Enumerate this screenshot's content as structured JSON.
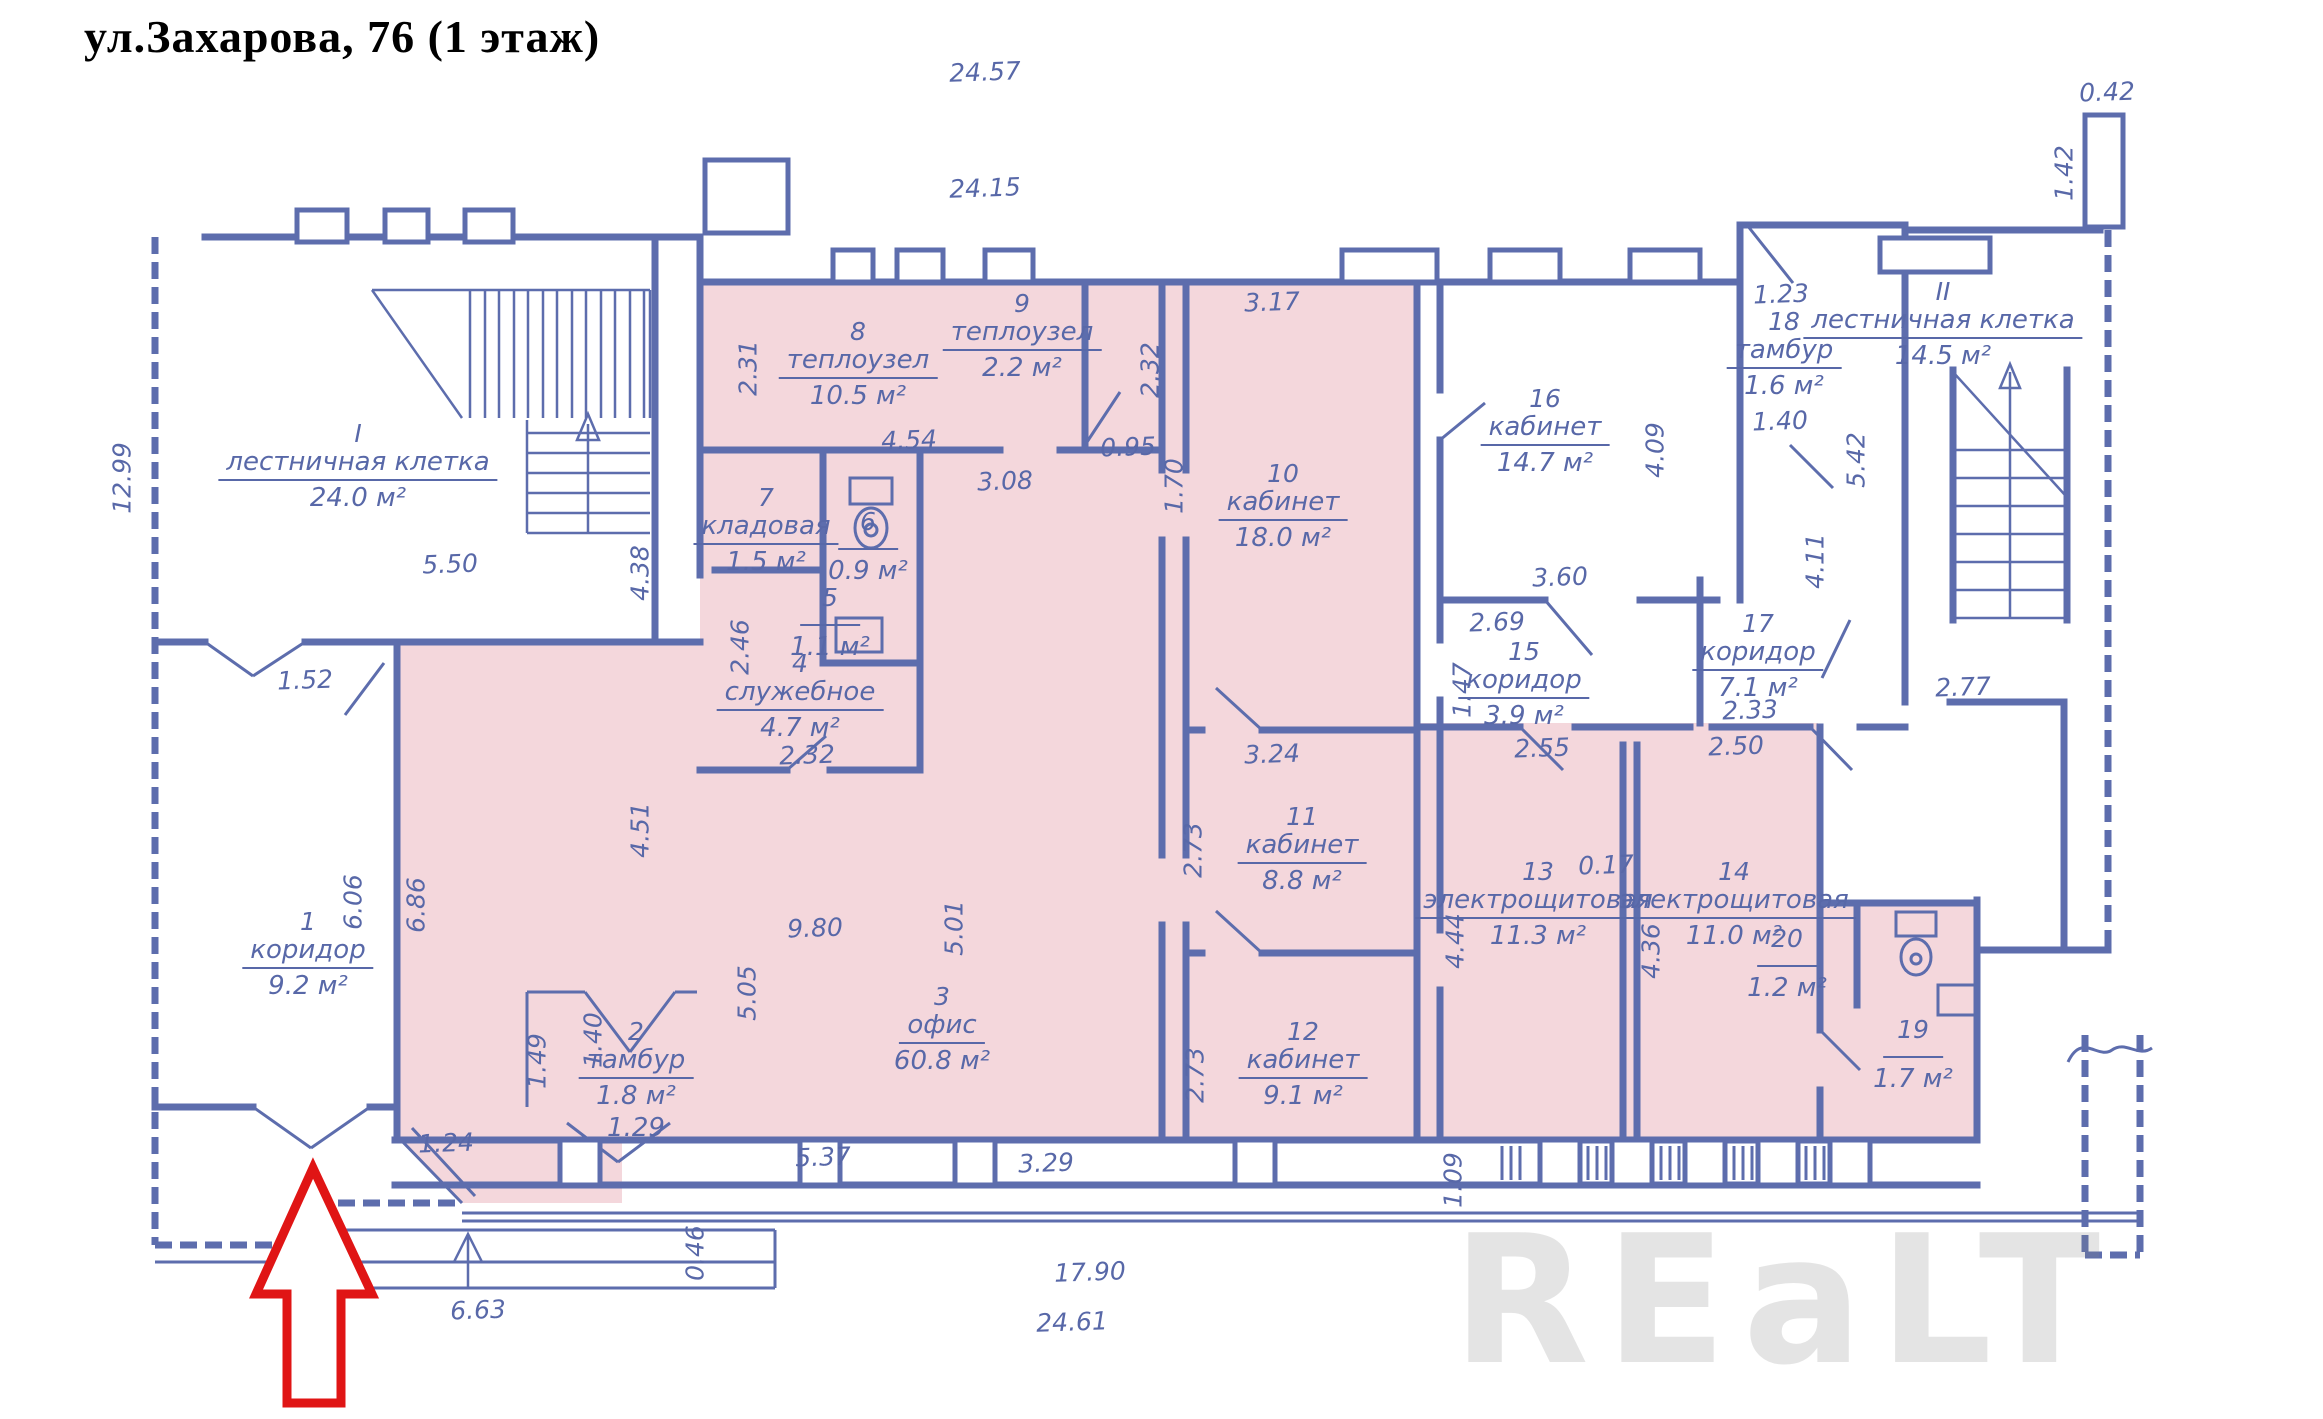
{
  "title": "ул.Захарова, 76 (1 этаж)",
  "watermark": "REaLT",
  "rooms": [
    {
      "number": "I",
      "name": "лестничная клетка",
      "area": "24.0 м²"
    },
    {
      "number": "II",
      "name": "лестничная клетка",
      "area": "14.5 м²"
    },
    {
      "number": "1",
      "name": "коридор",
      "area": "9.2 м²"
    },
    {
      "number": "2",
      "name": "тамбур",
      "area": "1.8 м²",
      "note": "1.29"
    },
    {
      "number": "3",
      "name": "офис",
      "area": "60.8 м²"
    },
    {
      "number": "4",
      "name": "служебное",
      "area": "4.7 м²"
    },
    {
      "number": "5",
      "name": "",
      "area": "1.1 м²"
    },
    {
      "number": "6",
      "name": "",
      "area": "0.9 м²"
    },
    {
      "number": "7",
      "name": "кладовая",
      "area": "1.5 м²"
    },
    {
      "number": "8",
      "name": "теплоузел",
      "area": "10.5 м²"
    },
    {
      "number": "9",
      "name": "теплоузел",
      "area": "2.2 м²"
    },
    {
      "number": "10",
      "name": "кабинет",
      "area": "18.0 м²"
    },
    {
      "number": "11",
      "name": "кабинет",
      "area": "8.8 м²"
    },
    {
      "number": "12",
      "name": "кабинет",
      "area": "9.1 м²"
    },
    {
      "number": "13",
      "name": "электрощитовая",
      "area": "11.3 м²"
    },
    {
      "number": "14",
      "name": "электрощитовая",
      "area": "11.0 м²"
    },
    {
      "number": "15",
      "name": "коридор",
      "area": "3.9 м²"
    },
    {
      "number": "16",
      "name": "кабинет",
      "area": "14.7 м²"
    },
    {
      "number": "17",
      "name": "коридор",
      "area": "7.1 м²"
    },
    {
      "number": "18",
      "name": "тамбур",
      "area": "1.6 м²"
    },
    {
      "number": "19",
      "name": "",
      "area": "1.7 м²"
    },
    {
      "number": "20",
      "name": "",
      "area": "1.2 м²"
    }
  ],
  "dims": [
    "24.57",
    "24.15",
    "0.42",
    "1.42",
    "12.99",
    "5.50",
    "4.38",
    "1.52",
    "2.31",
    "4.54",
    "2.32",
    "0.95",
    "3.08",
    "1.70",
    "3.17",
    "4.09",
    "3.60",
    "2.69",
    "1.47",
    "2.33",
    "4.11",
    "2.77",
    "5.42",
    "1.23",
    "1.40",
    "2.46",
    "2.32",
    "9.80",
    "5.01",
    "5.05",
    "4.51",
    "6.06",
    "6.86",
    "1.49",
    "1.40",
    "1.24",
    "5.37",
    "3.29",
    "0.46",
    "6.63",
    "17.90",
    "24.61",
    "1.09",
    "2.55",
    "2.50",
    "0.17",
    "4.36",
    "4.44",
    "3.24",
    "2.73",
    "2.73"
  ]
}
